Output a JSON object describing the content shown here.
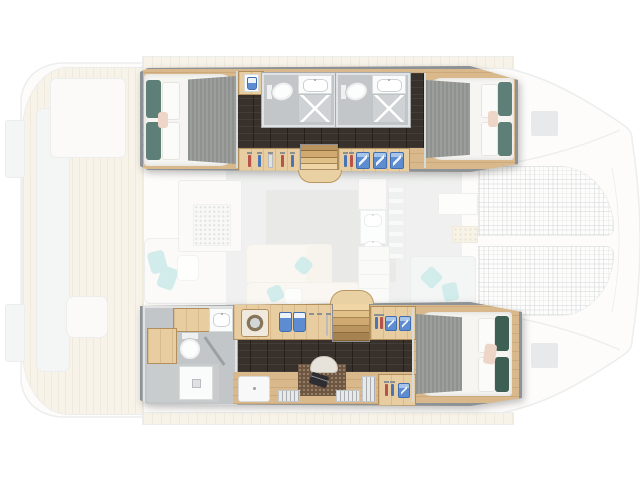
{
  "palette": {
    "page": "#ffffff",
    "wood": "#d9b98c",
    "wood-cab": "#e8cda1",
    "frame": "#8d9297",
    "floor-dark": "#38302a",
    "bath-floor": "#c2c6c8",
    "tile": "#ced2d4",
    "wall": "#e0e2e3",
    "duvet": "#f6f5f1",
    "runner": "#8f928f",
    "teal-dark": "#5e7f77",
    "green-dark": "#3e5f53",
    "blush": "#edd5c8",
    "teal": "#8ed2cd",
    "blue": "#5d8cd0",
    "deck-wood": "#eee2ca",
    "deck-line": "#dcccab",
    "salon-floor": "#d9dad9",
    "rug": "#c9cac8",
    "cream": "#f3ede1",
    "ghost-outline": "#d2d3d4",
    "bench": "#e6e7e7",
    "dark-laptop": "#2e2e32"
  },
  "floorplan": {
    "vessel": "catamaran",
    "view": "top-down-interior-layout",
    "highlighted_deck": {
      "port_hull": {
        "areas": [
          "aft-double-cabin",
          "washbasin-cabinet",
          "bathroom-1",
          "bathroom-2",
          "dark-teak-corridor",
          "wardrobe-hangers",
          "companionway-stairs",
          "wardrobe-shelves",
          "forward-double-cabin"
        ],
        "fixtures": [
          "double-bed",
          "teal-pillows",
          "gray-bed-runner",
          "toilet",
          "sink",
          "shower"
        ]
      },
      "starboard_hull": {
        "areas": [
          "bathroom-shower-room",
          "laundry-cabinet",
          "companionway-stairs",
          "wardrobe-hangers",
          "dark-teak-corridor",
          "desk-office",
          "forward-double-cabin"
        ],
        "fixtures": [
          "washing-machine",
          "toilet",
          "shower-tray",
          "desk",
          "laptop",
          "office-chair",
          "bookshelf",
          "double-bed",
          "green-pillows",
          "blush-pillow"
        ]
      }
    },
    "ghost_deck": {
      "areas": [
        "aft-cockpit",
        "swim-platforms",
        "cockpit-bench",
        "cockpit-table",
        "aft-lounge",
        "salon",
        "tv-speaker-cabinet",
        "salon-sofa",
        "galley",
        "appliance-tower",
        "foredeck",
        "sunpad",
        "deck-hatches",
        "windlass-panel",
        "bow-trampolines"
      ]
    }
  }
}
